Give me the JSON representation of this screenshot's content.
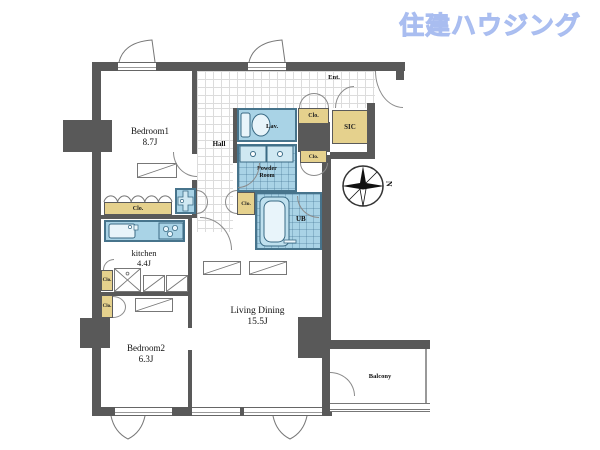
{
  "brand": {
    "logo_text": "住建ハウジング",
    "logo_color": "#b7c8f4"
  },
  "compass": {
    "north_label": "N"
  },
  "labels": {
    "bedroom1_name": "Bedroom1",
    "bedroom1_size": "8.7J",
    "bedroom2_name": "Bedroom2",
    "bedroom2_size": "6.3J",
    "kitchen_name": "kitchen",
    "kitchen_size": "4.4J",
    "living_dining_name": "Living Dining",
    "living_dining_size": "15.5J",
    "hall": "Hall",
    "entrance": "Ent.",
    "sic": "SIC",
    "lavatory": "Lav.",
    "powder_room_line1": "Powder",
    "powder_room_line2": "Room",
    "unit_bath": "UB",
    "balcony": "Balcony",
    "closet": "Clo."
  },
  "colors": {
    "wall": "#595959",
    "wet_area_fill": "#a9d3e6",
    "wet_area_border": "#47748c",
    "closet_fill": "#e5d18d",
    "logo_blue": "#b7c8f4"
  }
}
